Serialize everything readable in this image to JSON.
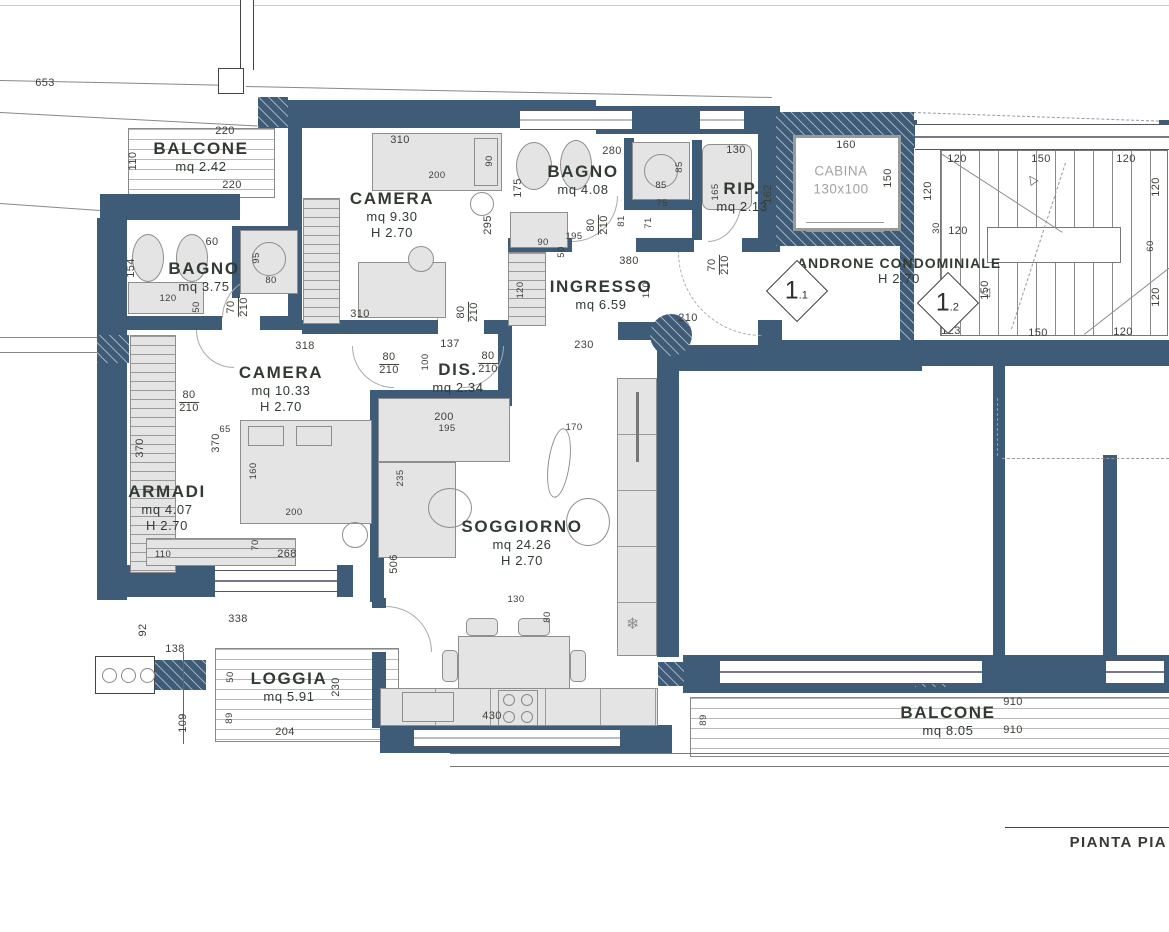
{
  "title": {
    "label": "PIANTA PIA"
  },
  "colors": {
    "wall": "#3e5b77",
    "furniture": "#e4e4e4",
    "furniture_stroke": "#8e8e8e",
    "dim_text": "#3c4138",
    "room_text": "#323b33",
    "cabina_text": "#a2a2a2"
  },
  "cabina": {
    "name": "CABINA",
    "size": "130x100"
  },
  "rooms": [
    {
      "id": "balcone-nord",
      "name": "BALCONE",
      "sub": [
        "mq 2.42"
      ],
      "x": 201,
      "y": 157
    },
    {
      "id": "camera-doppia",
      "name": "CAMERA",
      "sub": [
        "mq 9.30",
        "H 2.70"
      ],
      "x": 392,
      "y": 215
    },
    {
      "id": "bagno-principale",
      "name": "BAGNO",
      "sub": [
        "mq 4.08"
      ],
      "x": 583,
      "y": 180
    },
    {
      "id": "ripostiglio",
      "name": "RIP.",
      "sub": [
        "mq 2.13"
      ],
      "x": 742,
      "y": 197
    },
    {
      "id": "bagno-secondario",
      "name": "BAGNO",
      "sub": [
        "mq 3.75"
      ],
      "x": 204,
      "y": 277
    },
    {
      "id": "ingresso",
      "name": "INGRESSO",
      "sub": [
        "mq 6.59"
      ],
      "x": 601,
      "y": 295
    },
    {
      "id": "camera-singola",
      "name": "CAMERA",
      "sub": [
        "mq 10.33",
        "H 2.70"
      ],
      "x": 281,
      "y": 389
    },
    {
      "id": "disimpegno",
      "name": "DIS.",
      "sub": [
        "mq 2.34"
      ],
      "x": 458,
      "y": 378
    },
    {
      "id": "armadi",
      "name": "ARMADI",
      "sub": [
        "mq 4.07",
        "H 2.70"
      ],
      "x": 167,
      "y": 508
    },
    {
      "id": "soggiorno",
      "name": "SOGGIORNO",
      "sub": [
        "mq 24.26",
        "H 2.70"
      ],
      "x": 522,
      "y": 543
    },
    {
      "id": "loggia",
      "name": "LOGGIA",
      "sub": [
        "mq 5.91"
      ],
      "x": 289,
      "y": 687
    },
    {
      "id": "balcone-sud",
      "name": "BALCONE",
      "sub": [
        "mq 8.05"
      ],
      "x": 948,
      "y": 721
    },
    {
      "id": "androne",
      "name": "ANDRONE CONDOMINIALE",
      "sub": [
        "H 2.70"
      ],
      "x": 899,
      "y": 271,
      "small": true
    }
  ],
  "markers": [
    {
      "big": "1",
      "small": ".1",
      "x": 797,
      "y": 291
    },
    {
      "big": "1",
      "small": ".2",
      "x": 948,
      "y": 303
    }
  ],
  "dimensions": [
    {
      "t": "653",
      "x": 45,
      "y": 84
    },
    {
      "t": "220",
      "x": 225,
      "y": 132
    },
    {
      "t": "110",
      "x": 134,
      "y": 161,
      "r": 1
    },
    {
      "t": "220",
      "x": 232,
      "y": 186
    },
    {
      "t": "310",
      "x": 400,
      "y": 141
    },
    {
      "t": "90",
      "x": 490,
      "y": 161,
      "r": 1,
      "s": 1
    },
    {
      "t": "200",
      "x": 437,
      "y": 176,
      "s": 1
    },
    {
      "t": "295",
      "x": 489,
      "y": 225,
      "r": 1
    },
    {
      "t": "280",
      "x": 612,
      "y": 152
    },
    {
      "t": "175",
      "x": 519,
      "y": 188,
      "r": 1
    },
    {
      "t": "85",
      "x": 680,
      "y": 167,
      "r": 1,
      "s": 1
    },
    {
      "t": "85",
      "x": 661,
      "y": 186,
      "s": 1
    },
    {
      "t": "130",
      "x": 736,
      "y": 151
    },
    {
      "t": "160",
      "x": 846,
      "y": 146
    },
    {
      "t": "150",
      "x": 889,
      "y": 178,
      "r": 1
    },
    {
      "t": "162",
      "x": 769,
      "y": 194,
      "r": 1
    },
    {
      "t": "120",
      "x": 957,
      "y": 160
    },
    {
      "t": "150",
      "x": 1041,
      "y": 160
    },
    {
      "t": "120",
      "x": 1126,
      "y": 160
    },
    {
      "t": "120",
      "x": 929,
      "y": 191,
      "r": 1
    },
    {
      "t": "120",
      "x": 1157,
      "y": 187,
      "r": 1
    },
    {
      "t": "30",
      "x": 937,
      "y": 228,
      "r": 1,
      "s": 1
    },
    {
      "t": "120",
      "x": 958,
      "y": 232
    },
    {
      "t": "60",
      "x": 1151,
      "y": 246,
      "r": 1,
      "s": 1
    },
    {
      "t": "150",
      "x": 986,
      "y": 290,
      "r": 1
    },
    {
      "t": "120",
      "x": 1157,
      "y": 297,
      "r": 1
    },
    {
      "t": "123",
      "x": 951,
      "y": 332
    },
    {
      "t": "150",
      "x": 1038,
      "y": 334
    },
    {
      "t": "120",
      "x": 1123,
      "y": 333
    },
    {
      "t": "195",
      "x": 574,
      "y": 237,
      "s": 1
    },
    {
      "t": "90",
      "x": 543,
      "y": 243,
      "s": 1
    },
    {
      "t": "50",
      "x": 562,
      "y": 252,
      "r": 1,
      "s": 1
    },
    {
      "t": "165",
      "x": 716,
      "y": 192,
      "r": 1,
      "s": 1
    },
    {
      "t": "75",
      "x": 662,
      "y": 204,
      "s": 1
    },
    {
      "t": "71",
      "x": 649,
      "y": 223,
      "r": 1,
      "s": 1
    },
    {
      "t": "81",
      "x": 622,
      "y": 221,
      "r": 1,
      "s": 1
    },
    {
      "t": "80",
      "f": "210",
      "x": 598,
      "y": 225,
      "r": 1
    },
    {
      "t": "70",
      "f": "210",
      "x": 719,
      "y": 265,
      "r": 1
    },
    {
      "t": "380",
      "x": 629,
      "y": 262
    },
    {
      "t": "110",
      "x": 647,
      "y": 290,
      "r": 1,
      "s": 1
    },
    {
      "t": "120",
      "x": 521,
      "y": 290,
      "r": 1,
      "s": 1
    },
    {
      "t": "210",
      "x": 688,
      "y": 319
    },
    {
      "t": "70",
      "f": "210",
      "x": 238,
      "y": 307,
      "r": 1
    },
    {
      "t": "120",
      "x": 168,
      "y": 299,
      "s": 1
    },
    {
      "t": "50",
      "x": 197,
      "y": 307,
      "r": 1,
      "s": 1
    },
    {
      "t": "154",
      "x": 132,
      "y": 268,
      "r": 1
    },
    {
      "t": "60",
      "x": 212,
      "y": 243
    },
    {
      "t": "95",
      "x": 257,
      "y": 258,
      "r": 1,
      "s": 1
    },
    {
      "t": "80",
      "x": 271,
      "y": 281,
      "s": 1
    },
    {
      "t": "310",
      "x": 360,
      "y": 315
    },
    {
      "t": "80",
      "f": "210",
      "x": 468,
      "y": 312,
      "r": 1
    },
    {
      "t": "318",
      "x": 305,
      "y": 347
    },
    {
      "t": "137",
      "x": 450,
      "y": 345
    },
    {
      "t": "230",
      "x": 584,
      "y": 346
    },
    {
      "t": "80",
      "f": "210",
      "x": 389,
      "y": 364
    },
    {
      "t": "100",
      "x": 426,
      "y": 362,
      "r": 1,
      "s": 1
    },
    {
      "t": "80",
      "f": "210",
      "x": 488,
      "y": 363
    },
    {
      "t": "80",
      "f": "210",
      "x": 189,
      "y": 402
    },
    {
      "t": "370",
      "x": 141,
      "y": 448,
      "r": 1
    },
    {
      "t": "370",
      "x": 217,
      "y": 443,
      "r": 1
    },
    {
      "t": "65",
      "x": 225,
      "y": 430,
      "s": 1
    },
    {
      "t": "160",
      "x": 254,
      "y": 471,
      "r": 1,
      "s": 1
    },
    {
      "t": "200",
      "x": 294,
      "y": 513,
      "s": 1
    },
    {
      "t": "70",
      "x": 256,
      "y": 545,
      "r": 1,
      "s": 1
    },
    {
      "t": "110",
      "x": 163,
      "y": 555,
      "s": 1
    },
    {
      "t": "268",
      "x": 287,
      "y": 555
    },
    {
      "t": "200",
      "x": 444,
      "y": 418
    },
    {
      "t": "195",
      "x": 447,
      "y": 429,
      "s": 1
    },
    {
      "t": "170",
      "x": 574,
      "y": 428,
      "s": 1
    },
    {
      "t": "235",
      "x": 401,
      "y": 478,
      "r": 1,
      "s": 1
    },
    {
      "t": "506",
      "x": 395,
      "y": 564,
      "r": 1
    },
    {
      "t": "130",
      "x": 516,
      "y": 600,
      "s": 1
    },
    {
      "t": "80",
      "x": 548,
      "y": 617,
      "r": 1,
      "s": 1
    },
    {
      "t": "430",
      "x": 492,
      "y": 717
    },
    {
      "t": "92",
      "x": 144,
      "y": 630,
      "r": 1
    },
    {
      "t": "338",
      "x": 238,
      "y": 620
    },
    {
      "t": "138",
      "x": 175,
      "y": 650
    },
    {
      "t": "50",
      "x": 231,
      "y": 677,
      "r": 1,
      "s": 1
    },
    {
      "t": "89",
      "x": 230,
      "y": 718,
      "r": 1,
      "s": 1
    },
    {
      "t": "109",
      "x": 184,
      "y": 723,
      "r": 1
    },
    {
      "t": "204",
      "x": 285,
      "y": 733
    },
    {
      "t": "230",
      "x": 337,
      "y": 687,
      "r": 1
    },
    {
      "t": "89",
      "x": 704,
      "y": 720,
      "r": 1,
      "s": 1
    },
    {
      "t": "910",
      "x": 1013,
      "y": 703
    },
    {
      "t": "910",
      "x": 1013,
      "y": 731
    }
  ]
}
